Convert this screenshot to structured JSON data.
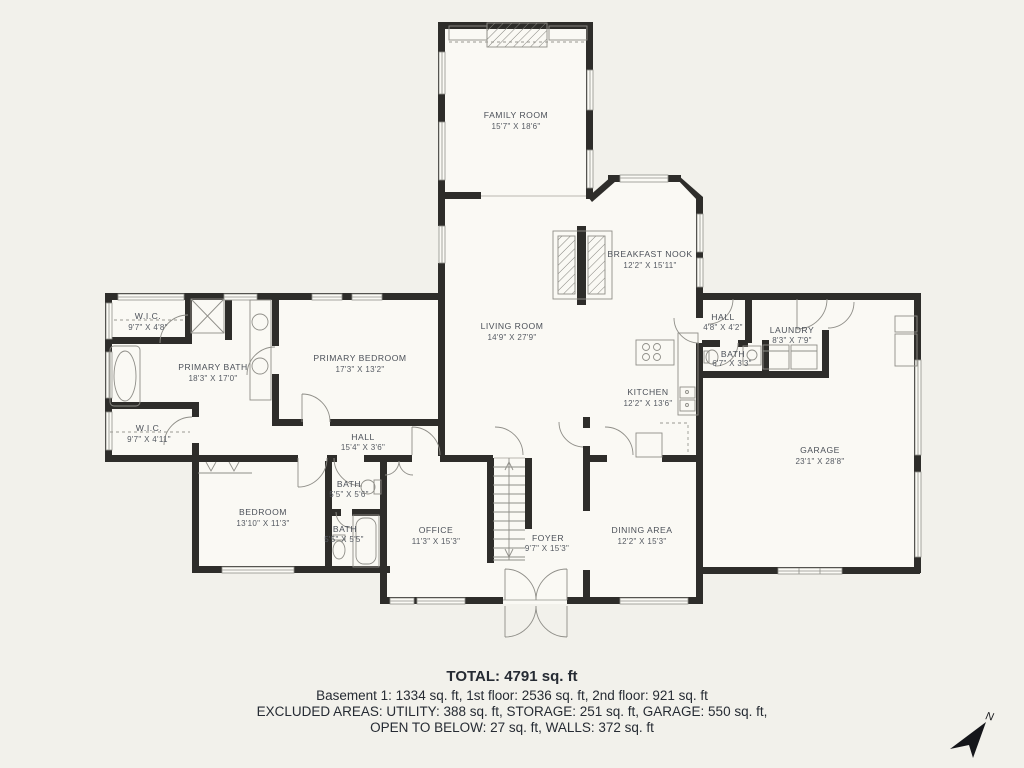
{
  "palette": {
    "background": "#f2f1eb",
    "floor": "#faf9f4",
    "wall": "#2e2d2a",
    "thin_line": "#8f8e88",
    "label_text": "#4b5058",
    "summary_text": "#262b33"
  },
  "rooms": [
    {
      "name": "FAMILY ROOM",
      "dims": "15'7\" X 18'6\""
    },
    {
      "name": "BREAKFAST NOOK",
      "dims": "12'2\" X 15'11\""
    },
    {
      "name": "LIVING ROOM",
      "dims": "14'9\" X 27'9\""
    },
    {
      "name": "W.I.C.",
      "dims": "9'7\" X 4'8\""
    },
    {
      "name": "PRIMARY BATH",
      "dims": "18'3\" X 17'0\""
    },
    {
      "name": "W.I.C.",
      "dims": "9'7\" X 4'11\""
    },
    {
      "name": "PRIMARY BEDROOM",
      "dims": "17'3\" X 13'2\""
    },
    {
      "name": "HALL",
      "dims": "15'4\" X 3'6\""
    },
    {
      "name": "HALL",
      "dims": "4'8\" X 4'2\""
    },
    {
      "name": "LAUNDRY",
      "dims": "8'3\" X 7'9\""
    },
    {
      "name": "BATH",
      "dims": "6'7\" X 3'3\""
    },
    {
      "name": "KITCHEN",
      "dims": "12'2\" X 13'6\""
    },
    {
      "name": "GARAGE",
      "dims": "23'1\" X 28'8\""
    },
    {
      "name": "BEDROOM",
      "dims": "13'10\" X 11'3\""
    },
    {
      "name": "BATH",
      "dims": "5'5\" X 5'6\""
    },
    {
      "name": "BATH",
      "dims": "5'5\" X 5'5\""
    },
    {
      "name": "OFFICE",
      "dims": "11'3\" X 15'3\""
    },
    {
      "name": "FOYER",
      "dims": "9'7\" X 15'3\""
    },
    {
      "name": "DINING AREA",
      "dims": "12'2\" X 15'3\""
    }
  ],
  "summary": {
    "total": "TOTAL: 4791 sq. ft",
    "floors": "Basement 1: 1334 sq. ft, 1st floor: 2536 sq. ft, 2nd floor: 921 sq. ft",
    "excluded": "EXCLUDED AREAS: UTILITY: 388 sq. ft, STORAGE: 251 sq. ft, GARAGE: 550 sq. ft,",
    "open_below": "OPEN TO BELOW: 27 sq. ft, WALLS: 372 sq. ft"
  },
  "compass": {
    "label": "N"
  }
}
